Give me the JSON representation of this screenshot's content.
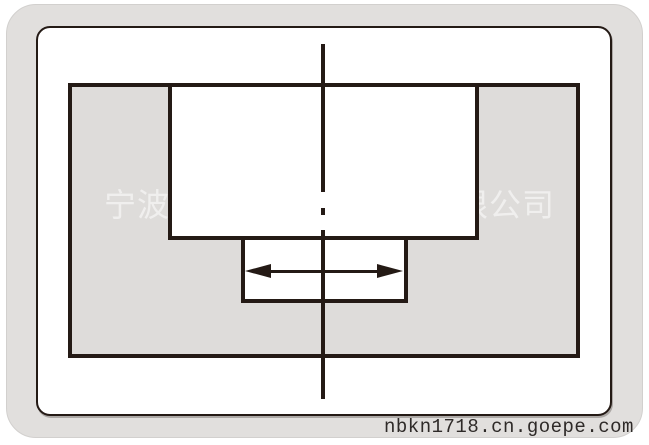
{
  "watermark": {
    "left_text": "宁波",
    "right_text": "限公司"
  },
  "footer": {
    "url_text": "nbkn1718.cn.goepe.com"
  },
  "colors": {
    "line": "#241a15",
    "outer_panel_bg": "#e1dfdd",
    "drawing_fill": "#dedcda",
    "canvas_bg": "#ffffff",
    "footer_text": "#2e2a28",
    "watermark_text": "rgba(255,255,255,0.55)"
  }
}
